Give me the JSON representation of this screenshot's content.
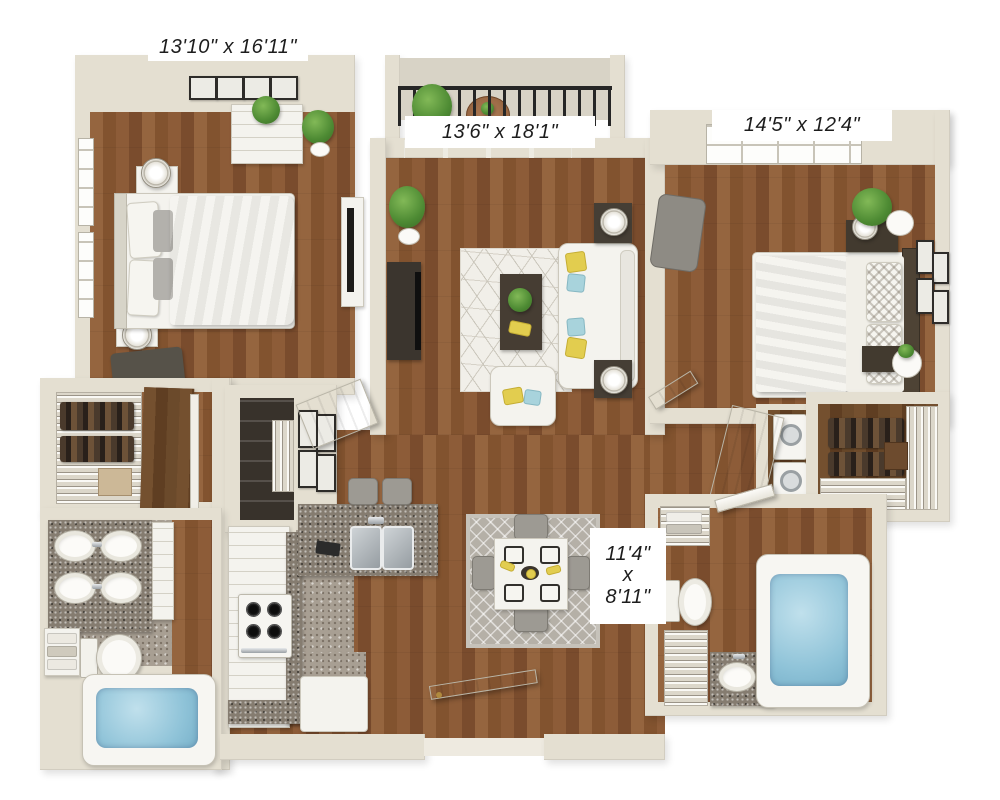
{
  "plan": {
    "type": "3d-apartment-floor-plan",
    "labels": {
      "bedroom1": "13'10\" x 16'11\"",
      "living": "13'6\" x 18'1\"",
      "bedroom2": "14'5\" x 12'4\"",
      "dining_line1": "11'4\"",
      "dining_line2": "x",
      "dining_line3": "8'11\""
    },
    "colors": {
      "background": "#ffffff",
      "wall": "#e4dfd1",
      "wood_floor": "#8f5f3a",
      "kitchen_tile": "#a89f93",
      "granite_counter": "#857c70",
      "accent_yellow": "#e2cd4f",
      "accent_blue": "#a8d3dc",
      "plant_green": "#4d8a33",
      "tub_water": "#8fc3d8",
      "railing": "#262626",
      "label_text": "#1d1d1d",
      "label_background": "#ffffff"
    }
  }
}
